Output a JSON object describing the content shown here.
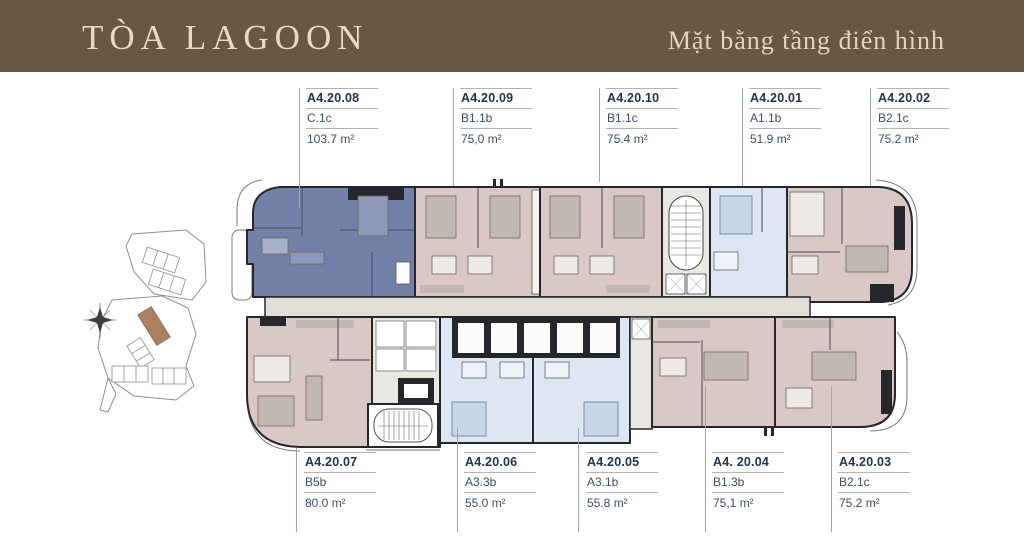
{
  "header": {
    "title": "TÒA LAGOON",
    "subtitle": "Mặt bằng tầng điển hình"
  },
  "top_labels": [
    {
      "unit": "A4.20.08",
      "type": "C.1c",
      "area": "103.7 m²"
    },
    {
      "unit": "A4.20.09",
      "type": "B1.1b",
      "area": "75,0 m²"
    },
    {
      "unit": "A4.20.10",
      "type": "B1.1c",
      "area": "75.4 m²"
    },
    {
      "unit": "A4.20.01",
      "type": "A1.1b",
      "area": "51.9 m²"
    },
    {
      "unit": "A4.20.02",
      "type": "B2.1c",
      "area": "75.2 m²"
    }
  ],
  "bottom_labels": [
    {
      "unit": "A4.20.07",
      "type": "B5b",
      "area": "80.0 m²"
    },
    {
      "unit": "A4.20.06",
      "type": "A3.3b",
      "area": "55.0 m²"
    },
    {
      "unit": "A4.20.05",
      "type": "A3.1b",
      "area": "55.8 m²"
    },
    {
      "unit": "A4. 20.04",
      "type": "B1.3b",
      "area": "75,1 m²"
    },
    {
      "unit": "A4.20.03",
      "type": "B2.1c",
      "area": "75.2 m²"
    }
  ],
  "colors": {
    "header_bg": "#6a5645",
    "header_text": "#ead8c6",
    "label_navy": "#223450",
    "label_secondary": "#3e4e66",
    "unit_highlighted": "#7380a8",
    "unit_pink": "#d9c8c6",
    "unit_light_blue": "#dde7f3",
    "corridor": "#e1ded7",
    "core_gray": "#eae8e2",
    "wall": "#26262d",
    "minimap_highlight": "#aa7f62"
  }
}
